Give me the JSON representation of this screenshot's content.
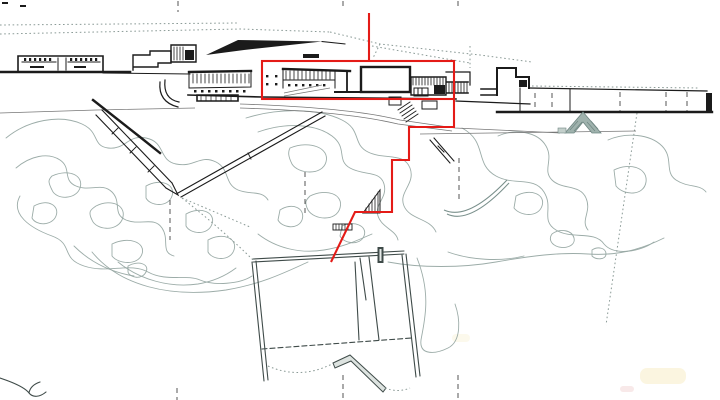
{
  "title": "architectural-site-plan",
  "canvas": {
    "width": 720,
    "height": 400
  },
  "colors": {
    "background": "#ffffff",
    "ink": "#1b1b1b",
    "contour": "#97a8a3",
    "field_outline": "#3f4b49",
    "dotted_boundary": "#8a9a96",
    "red_marker": "#e41b17",
    "paper_stain": "#faf3da"
  },
  "red_overlay": {
    "plumb_line": {
      "x": 369,
      "y1": 13,
      "y2": 61
    },
    "highlight_rect": {
      "x": 262,
      "y": 61,
      "width": 192,
      "height": 38
    },
    "stepped_path_points": "454,99 454,127 409,127 409,160 392,160 392,212 355,212 331,262"
  }
}
